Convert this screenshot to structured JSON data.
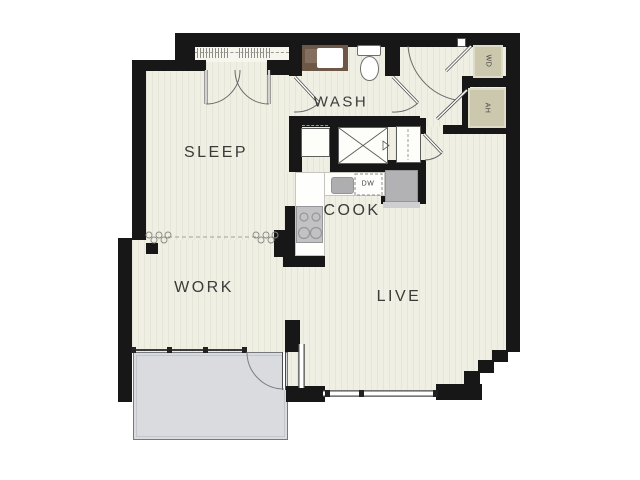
{
  "floor_plan": {
    "room_labels": {
      "sleep": "SLEEP",
      "wash": "WASH",
      "cook": "COOK",
      "work": "WORK",
      "live": "LIVE"
    },
    "fixture_labels": {
      "dishwasher": "DW",
      "washer_dryer": "WD",
      "air_handler": "AH"
    },
    "colors": {
      "wall": "#171717",
      "floor": "#f0efe3",
      "closet_floor": "#f7f6ee",
      "balcony": "#d9dbde",
      "utility_closet": "#cbc8ad",
      "vanity_brown": "#6d5848",
      "appliance_gray": "#b2b2b4",
      "line": "#555555"
    }
  }
}
